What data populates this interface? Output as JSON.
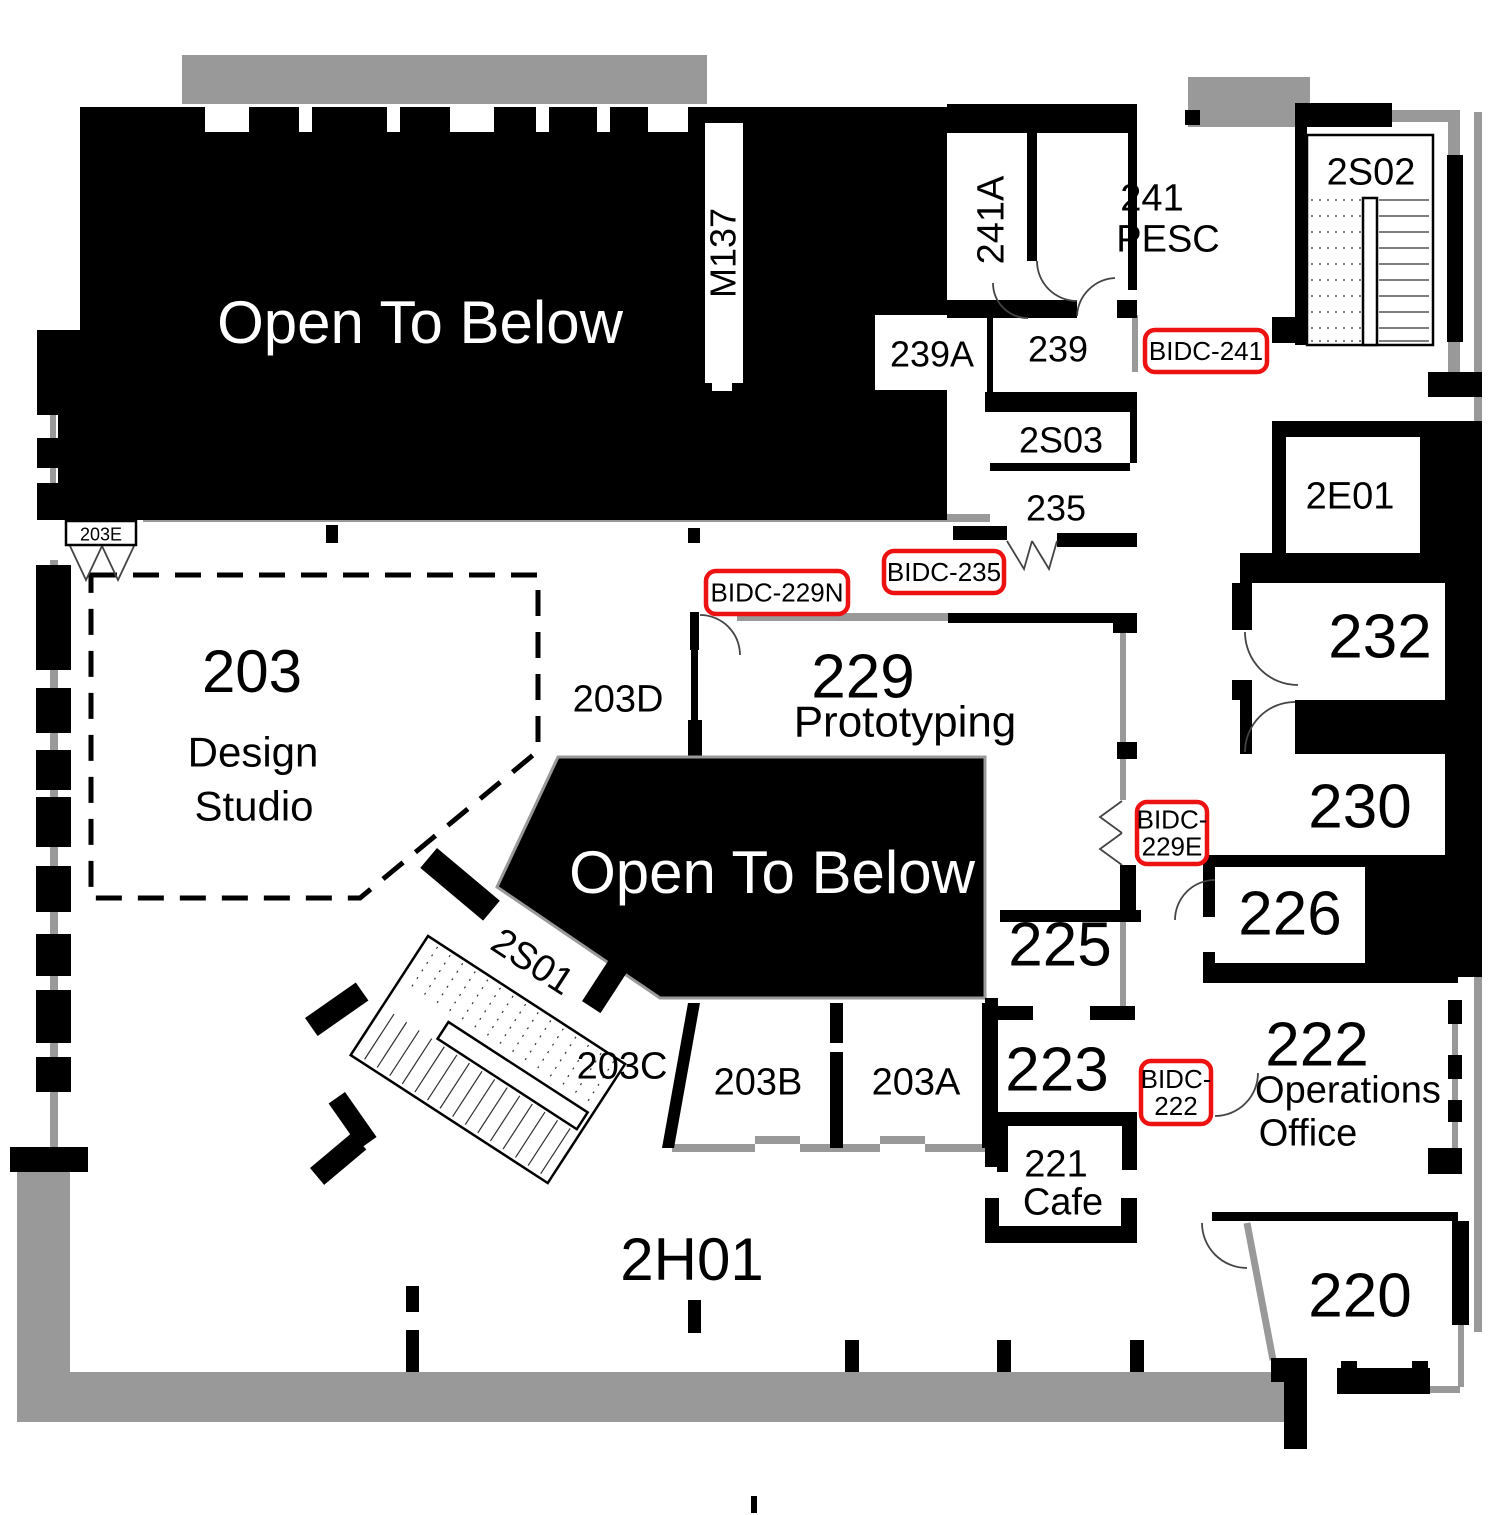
{
  "colors": {
    "wall_black": "#000000",
    "wall_gray": "#999999",
    "tag_border": "#EE1111",
    "text_black": "#000000",
    "text_white": "#ffffff",
    "background": "#ffffff"
  },
  "labels": [
    {
      "text": "Open To Below",
      "x": 420,
      "y": 322,
      "size": 60,
      "color": "#ffffff",
      "rot": 0
    },
    {
      "text": "Open To Below",
      "x": 772,
      "y": 872,
      "size": 60,
      "color": "#ffffff",
      "rot": 0
    },
    {
      "text": "M137",
      "x": 723,
      "y": 253,
      "size": 36,
      "color": "#000000",
      "rot": -90
    },
    {
      "text": "241A",
      "x": 990,
      "y": 220,
      "size": 38,
      "color": "#000000",
      "rot": -90
    },
    {
      "text": "241",
      "x": 1152,
      "y": 197,
      "size": 38,
      "color": "#000000",
      "rot": 0
    },
    {
      "text": "PESC",
      "x": 1168,
      "y": 238,
      "size": 38,
      "color": "#000000",
      "rot": 0
    },
    {
      "text": "2S02",
      "x": 1371,
      "y": 171,
      "size": 38,
      "color": "#000000",
      "rot": 0
    },
    {
      "text": "239A",
      "x": 932,
      "y": 354,
      "size": 36,
      "color": "#000000",
      "rot": 0
    },
    {
      "text": "239",
      "x": 1058,
      "y": 349,
      "size": 36,
      "color": "#000000",
      "rot": 0
    },
    {
      "text": "2S03",
      "x": 1061,
      "y": 440,
      "size": 36,
      "color": "#000000",
      "rot": 0
    },
    {
      "text": "235",
      "x": 1056,
      "y": 508,
      "size": 36,
      "color": "#000000",
      "rot": 0
    },
    {
      "text": "2E01",
      "x": 1350,
      "y": 495,
      "size": 38,
      "color": "#000000",
      "rot": 0
    },
    {
      "text": "232",
      "x": 1380,
      "y": 636,
      "size": 62,
      "color": "#000000",
      "rot": 0
    },
    {
      "text": "230",
      "x": 1360,
      "y": 806,
      "size": 62,
      "color": "#000000",
      "rot": 0
    },
    {
      "text": "226",
      "x": 1290,
      "y": 913,
      "size": 62,
      "color": "#000000",
      "rot": 0
    },
    {
      "text": "225",
      "x": 1060,
      "y": 944,
      "size": 62,
      "color": "#000000",
      "rot": 0
    },
    {
      "text": "229",
      "x": 863,
      "y": 676,
      "size": 62,
      "color": "#000000",
      "rot": 0
    },
    {
      "text": "Prototyping",
      "x": 905,
      "y": 721,
      "size": 44,
      "color": "#000000",
      "rot": 0
    },
    {
      "text": "203D",
      "x": 618,
      "y": 698,
      "size": 38,
      "color": "#000000",
      "rot": 0
    },
    {
      "text": "203",
      "x": 252,
      "y": 671,
      "size": 60,
      "color": "#000000",
      "rot": 0
    },
    {
      "text": "Design",
      "x": 253,
      "y": 752,
      "size": 42,
      "color": "#000000",
      "rot": 0
    },
    {
      "text": "Studio",
      "x": 254,
      "y": 806,
      "size": 42,
      "color": "#000000",
      "rot": 0
    },
    {
      "text": "203E",
      "x": 101,
      "y": 534,
      "size": 18,
      "color": "#000000",
      "rot": 0
    },
    {
      "text": "2S01",
      "x": 533,
      "y": 961,
      "size": 38,
      "color": "#000000",
      "rot": 33
    },
    {
      "text": "203C",
      "x": 622,
      "y": 1065,
      "size": 38,
      "color": "#000000",
      "rot": 0
    },
    {
      "text": "203B",
      "x": 758,
      "y": 1081,
      "size": 38,
      "color": "#000000",
      "rot": 0
    },
    {
      "text": "203A",
      "x": 916,
      "y": 1081,
      "size": 38,
      "color": "#000000",
      "rot": 0
    },
    {
      "text": "223",
      "x": 1057,
      "y": 1069,
      "size": 62,
      "color": "#000000",
      "rot": 0
    },
    {
      "text": "221",
      "x": 1056,
      "y": 1163,
      "size": 38,
      "color": "#000000",
      "rot": 0
    },
    {
      "text": "Cafe",
      "x": 1063,
      "y": 1201,
      "size": 38,
      "color": "#000000",
      "rot": 0
    },
    {
      "text": "222",
      "x": 1317,
      "y": 1044,
      "size": 62,
      "color": "#000000",
      "rot": 0
    },
    {
      "text": "Operations",
      "x": 1348,
      "y": 1089,
      "size": 38,
      "color": "#000000",
      "rot": 0
    },
    {
      "text": "Office",
      "x": 1308,
      "y": 1132,
      "size": 38,
      "color": "#000000",
      "rot": 0
    },
    {
      "text": "220",
      "x": 1360,
      "y": 1295,
      "size": 62,
      "color": "#000000",
      "rot": 0
    },
    {
      "text": "2H01",
      "x": 692,
      "y": 1259,
      "size": 60,
      "color": "#000000",
      "rot": 0
    }
  ],
  "tags": [
    {
      "lines": [
        "BIDC-241"
      ],
      "x": 1145,
      "y": 330,
      "w": 122,
      "h": 42
    },
    {
      "lines": [
        "BIDC-235"
      ],
      "x": 884,
      "y": 551,
      "w": 120,
      "h": 42
    },
    {
      "lines": [
        "BIDC-229N"
      ],
      "x": 706,
      "y": 571,
      "w": 142,
      "h": 43
    },
    {
      "lines": [
        "BIDC-",
        "229E"
      ],
      "x": 1137,
      "y": 802,
      "w": 70,
      "h": 62
    },
    {
      "lines": [
        "BIDC-",
        "222"
      ],
      "x": 1141,
      "y": 1061,
      "w": 70,
      "h": 63
    }
  ]
}
